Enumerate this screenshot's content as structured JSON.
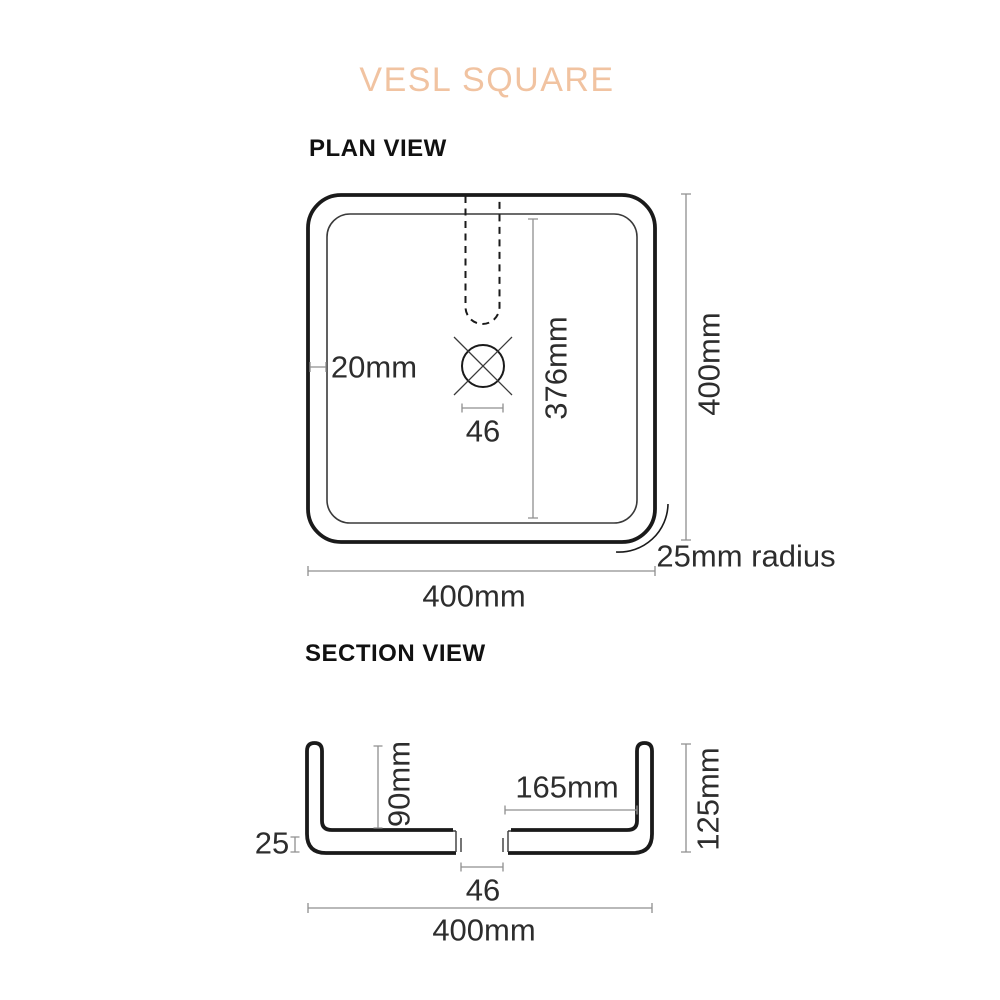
{
  "title": "VESL SQUARE",
  "plan_view": {
    "heading": "PLAN VIEW",
    "dimensions": {
      "rim_width": "20mm",
      "drain_width": "46",
      "inner_length": "376mm",
      "overall_height": "400mm",
      "corner_radius": "25mm radius",
      "overall_width": "400mm"
    }
  },
  "section_view": {
    "heading": "SECTION VIEW",
    "dimensions": {
      "bowl_depth": "90mm",
      "drain_to_wall": "165mm",
      "overall_height": "125mm",
      "base_thickness": "25",
      "drain_width": "46",
      "overall_width": "400mm"
    }
  },
  "colors": {
    "accent": "#f1c3a1",
    "line_dark": "#1a1a1a",
    "line_thin": "#3a3a3a",
    "dimension_line": "#8f8f8f",
    "text": "#2d2d2d"
  }
}
